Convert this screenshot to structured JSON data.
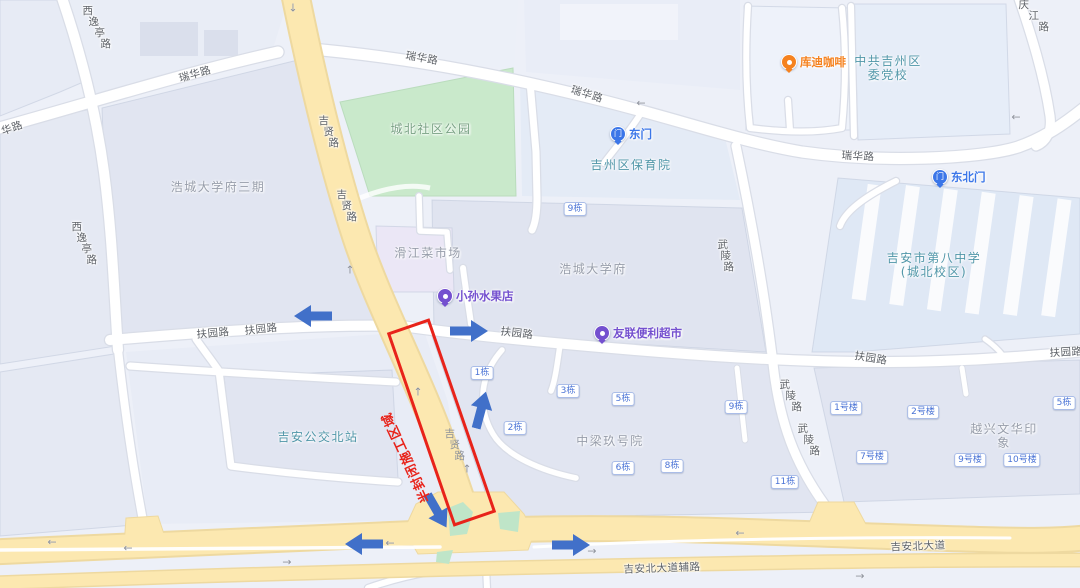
{
  "theme": {
    "base_bg": "#edf0f8",
    "road_yellow": "#fce8b0",
    "road_yellow_casing": "#eed9a0",
    "road_white_casing": "#d9dde7",
    "park_green": "#c9e9cb",
    "island_green": "#bfe5c8",
    "annotation_red": "#e8231a",
    "arrow_blue": "#4170c9",
    "badge_blue": "#4b74d6",
    "road_label_gray": "#5d6167",
    "residential_label": "#979daa",
    "public_label": "#5096a8",
    "park_label": "#79a184"
  },
  "map": {
    "road_labels": [
      {
        "text": "华路",
        "x": 12,
        "y": 128,
        "rot": -20
      },
      {
        "text": "瑞华路",
        "x": 195,
        "y": 74,
        "rot": -16
      },
      {
        "text": "瑞华路",
        "x": 422,
        "y": 58,
        "rot": 10
      },
      {
        "text": "瑞华路",
        "x": 587,
        "y": 94,
        "rot": 17
      },
      {
        "text": "瑞华路",
        "x": 858,
        "y": 156,
        "rot": 3
      },
      {
        "text": "西逸亭路",
        "x": 82,
        "y": 6,
        "stack": 6
      },
      {
        "text": "西逸亭路",
        "x": 71,
        "y": 222,
        "stack": 5
      },
      {
        "text": "庆江路",
        "x": 1018,
        "y": 0,
        "stack": 10
      },
      {
        "text": "吉贤路",
        "x": 318,
        "y": 116,
        "stack": 5
      },
      {
        "text": "吉贤路",
        "x": 336,
        "y": 190,
        "stack": 5
      },
      {
        "text": "吉贤路",
        "x": 444,
        "y": 429,
        "stack": 5,
        "onroad": true
      },
      {
        "text": "扶园路",
        "x": 213,
        "y": 333,
        "rot": -5
      },
      {
        "text": "扶园路",
        "x": 261,
        "y": 329,
        "rot": -6
      },
      {
        "text": "扶园路",
        "x": 517,
        "y": 333,
        "rot": 7
      },
      {
        "text": "扶园路",
        "x": 871,
        "y": 358,
        "rot": 9
      },
      {
        "text": "扶园路",
        "x": 1066,
        "y": 352,
        "rot": -3
      },
      {
        "text": "武陵路",
        "x": 717,
        "y": 240,
        "stack": 3
      },
      {
        "text": "武陵路",
        "x": 779,
        "y": 380,
        "stack": 6
      },
      {
        "text": "武陵路",
        "x": 797,
        "y": 424,
        "stack": 6
      },
      {
        "text": "吉安北大道",
        "x": 918,
        "y": 546,
        "rot": -2
      },
      {
        "text": "吉安北大道辅路",
        "x": 662,
        "y": 568,
        "rot": -2
      }
    ],
    "area_labels": [
      {
        "lines": [
          "浩城大学府三期"
        ],
        "x": 218,
        "y": 187,
        "type": "res"
      },
      {
        "lines": [
          "城北社区公园"
        ],
        "x": 431,
        "y": 129,
        "type": "park"
      },
      {
        "lines": [
          "滑江菜市场"
        ],
        "x": 428,
        "y": 253,
        "type": "res"
      },
      {
        "lines": [
          "浩城大学府"
        ],
        "x": 593,
        "y": 269,
        "type": "res"
      },
      {
        "lines": [
          "吉州区保育院"
        ],
        "x": 631,
        "y": 165,
        "type": "pub"
      },
      {
        "lines": [
          "中共吉州区",
          "委党校"
        ],
        "x": 888,
        "y": 68,
        "type": "pub"
      },
      {
        "lines": [
          "吉安市第八中学",
          "(城北校区)"
        ],
        "x": 934,
        "y": 265,
        "type": "pub"
      },
      {
        "lines": [
          "吉安公交北站"
        ],
        "x": 318,
        "y": 437,
        "type": "pub"
      },
      {
        "lines": [
          "中梁玖号院"
        ],
        "x": 610,
        "y": 441,
        "type": "res"
      },
      {
        "lines": [
          "越兴文华印象"
        ],
        "x": 1004,
        "y": 436,
        "type": "res"
      }
    ],
    "pois": [
      {
        "text": "库迪咖啡",
        "x": 789,
        "y": 62,
        "color": "#f5821f",
        "glyph": ""
      },
      {
        "text": "东门",
        "x": 618,
        "y": 134,
        "color": "#3b76e8",
        "glyph": "门"
      },
      {
        "text": "东北门",
        "x": 940,
        "y": 177,
        "color": "#3b76e8",
        "glyph": "门"
      },
      {
        "text": "小孙水果店",
        "x": 445,
        "y": 296,
        "color": "#7450cf",
        "glyph": ""
      },
      {
        "text": "友联便利超市",
        "x": 602,
        "y": 333,
        "color": "#7450cf",
        "glyph": ""
      }
    ],
    "badges": [
      {
        "text": "9栋",
        "x": 575,
        "y": 209
      },
      {
        "text": "1栋",
        "x": 482,
        "y": 373
      },
      {
        "text": "3栋",
        "x": 568,
        "y": 391
      },
      {
        "text": "5栋",
        "x": 623,
        "y": 399
      },
      {
        "text": "9栋",
        "x": 736,
        "y": 407
      },
      {
        "text": "2栋",
        "x": 515,
        "y": 428
      },
      {
        "text": "6栋",
        "x": 623,
        "y": 468
      },
      {
        "text": "8栋",
        "x": 672,
        "y": 466
      },
      {
        "text": "11栋",
        "x": 785,
        "y": 482
      },
      {
        "text": "1号楼",
        "x": 846,
        "y": 408
      },
      {
        "text": "2号楼",
        "x": 923,
        "y": 412
      },
      {
        "text": "5栋",
        "x": 1064,
        "y": 403
      },
      {
        "text": "7号楼",
        "x": 872,
        "y": 457
      },
      {
        "text": "9号楼",
        "x": 970,
        "y": 460
      },
      {
        "text": "10号楼",
        "x": 1022,
        "y": 460
      }
    ],
    "big_arrows": [
      {
        "x": 313,
        "y": 316,
        "rot": 180
      },
      {
        "x": 469,
        "y": 331,
        "rot": 0
      },
      {
        "x": 481,
        "y": 410,
        "rot": -75
      },
      {
        "x": 437,
        "y": 511,
        "rot": 60
      },
      {
        "x": 364,
        "y": 544,
        "rot": 180
      },
      {
        "x": 571,
        "y": 545,
        "rot": 0
      }
    ],
    "small_arrows": [
      {
        "ch": "↓",
        "x": 293,
        "y": 8
      },
      {
        "ch": "←",
        "x": 641,
        "y": 103
      },
      {
        "ch": "←",
        "x": 1016,
        "y": 117
      },
      {
        "ch": "↑",
        "x": 350,
        "y": 270
      },
      {
        "ch": "↑",
        "x": 418,
        "y": 392
      },
      {
        "ch": "↑",
        "x": 467,
        "y": 469
      },
      {
        "ch": "←",
        "x": 52,
        "y": 542
      },
      {
        "ch": "←",
        "x": 128,
        "y": 548
      },
      {
        "ch": "→",
        "x": 287,
        "y": 562
      },
      {
        "ch": "←",
        "x": 390,
        "y": 543
      },
      {
        "ch": "→",
        "x": 592,
        "y": 551
      },
      {
        "ch": "←",
        "x": 740,
        "y": 533
      },
      {
        "ch": "→",
        "x": 860,
        "y": 576
      }
    ],
    "construction": {
      "label": "半封闭施工区域",
      "color": "#e8231a",
      "rect": {
        "cx": 441,
        "cy": 422,
        "w": 45,
        "h": 205,
        "rot": -19
      },
      "label_pos": {
        "cx": 405,
        "cy": 458,
        "rot": -115,
        "font": 13
      }
    }
  }
}
